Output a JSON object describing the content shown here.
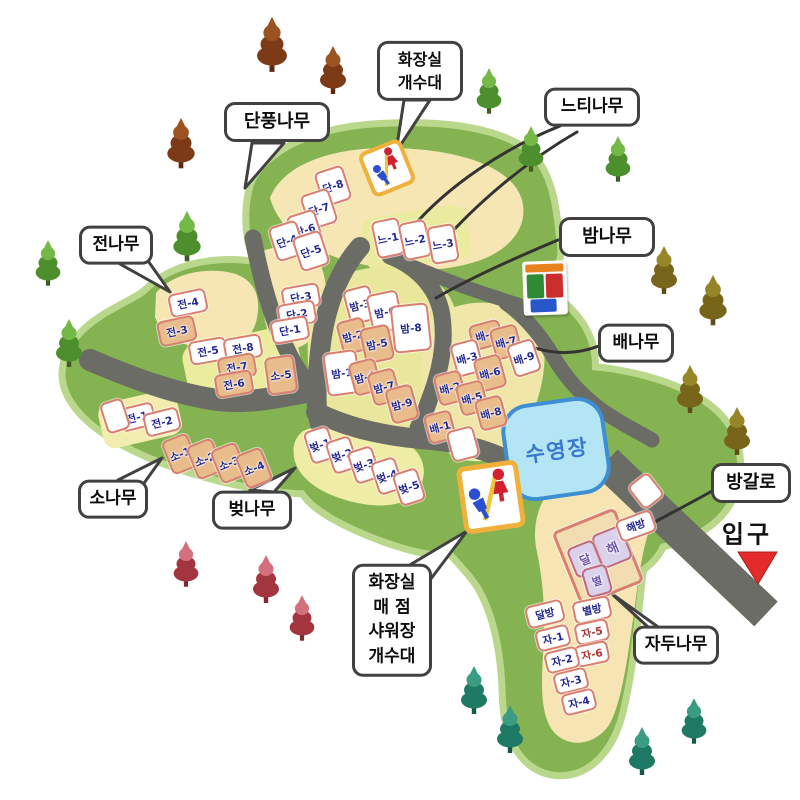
{
  "facilities": {
    "pool_label": "수영장",
    "entrance_label": "입구",
    "restroom_icon": "restroom-sign",
    "recycling_icon": "recycling-bins"
  },
  "colors": {
    "land_green": "#85b351",
    "land_edge": "#bad88c",
    "road_gray": "#6b6c66",
    "cream_area": "#f6e6b4",
    "yellow_area": "#e9e79b",
    "site_border": "#d97f6f",
    "site_tan": "#e9bc8c",
    "label_navy": "#23278f",
    "label_red": "#b03030",
    "label_purple": "#6f58a8",
    "pool_water": "#b3e5f4",
    "pool_border": "#3e8ed2",
    "entrance_arrow": "#e42a2a",
    "restroom_border": "#f0b13c",
    "male_blue": "#2b4fd0",
    "female_red": "#d32030"
  },
  "callouts": [
    {
      "id": "toilet-sink-top",
      "lines": [
        "화장실",
        "개수대"
      ],
      "x": 420,
      "y": 71,
      "w": 86,
      "fs": 16
    },
    {
      "id": "maple",
      "lines": [
        "단풍나무"
      ],
      "x": 277,
      "y": 122,
      "w": 106,
      "fs": 18
    },
    {
      "id": "zelkova",
      "lines": [
        "느티나무"
      ],
      "x": 592,
      "y": 107,
      "w": 96,
      "fs": 17
    },
    {
      "id": "fir",
      "lines": [
        "전나무"
      ],
      "x": 116,
      "y": 245,
      "w": 74,
      "fs": 17
    },
    {
      "id": "chestnut",
      "lines": [
        "밤나무"
      ],
      "x": 607,
      "y": 237,
      "w": 96,
      "fs": 18
    },
    {
      "id": "pear",
      "lines": [
        "배나무"
      ],
      "x": 636,
      "y": 343,
      "w": 76,
      "fs": 17
    },
    {
      "id": "pine",
      "lines": [
        "소나무"
      ],
      "x": 113,
      "y": 499,
      "w": 70,
      "fs": 17
    },
    {
      "id": "cherry",
      "lines": [
        "벚나무"
      ],
      "x": 252,
      "y": 510,
      "w": 80,
      "fs": 17
    },
    {
      "id": "bungalow",
      "lines": [
        "방갈로"
      ],
      "x": 751,
      "y": 483,
      "w": 80,
      "fs": 18
    },
    {
      "id": "plum",
      "lines": [
        "자두나무"
      ],
      "x": 676,
      "y": 645,
      "w": 86,
      "fs": 17
    },
    {
      "id": "services-bottom",
      "lines": [
        "화장실",
        "매 점",
        "샤워장",
        "개수대"
      ],
      "x": 392,
      "y": 620,
      "w": 80,
      "fs": 17
    }
  ],
  "sites": [
    {
      "label": "단-8",
      "x": 333,
      "y": 186,
      "w": 26,
      "h": 32,
      "rot": -18,
      "variant": "white"
    },
    {
      "label": "단-7",
      "x": 319,
      "y": 209,
      "w": 26,
      "h": 32,
      "rot": -18,
      "variant": "white"
    },
    {
      "label": "단-6",
      "x": 305,
      "y": 230,
      "w": 26,
      "h": 32,
      "rot": -18,
      "variant": "white"
    },
    {
      "label": "단-4",
      "x": 287,
      "y": 241,
      "w": 26,
      "h": 32,
      "rot": -18,
      "variant": "white"
    },
    {
      "label": "단-5",
      "x": 311,
      "y": 251,
      "w": 26,
      "h": 32,
      "rot": -18,
      "variant": "white"
    },
    {
      "label": "단-3",
      "x": 301,
      "y": 297,
      "w": 34,
      "h": 20,
      "rot": -10,
      "variant": "white"
    },
    {
      "label": "단-2",
      "x": 297,
      "y": 314,
      "w": 34,
      "h": 20,
      "rot": -10,
      "variant": "white"
    },
    {
      "label": "단-1",
      "x": 290,
      "y": 330,
      "w": 34,
      "h": 20,
      "rot": -10,
      "variant": "white"
    },
    {
      "label": "느-1",
      "x": 388,
      "y": 238,
      "w": 24,
      "h": 34,
      "rot": -12,
      "variant": "white"
    },
    {
      "label": "느-2",
      "x": 415,
      "y": 240,
      "w": 24,
      "h": 34,
      "rot": -12,
      "variant": "white"
    },
    {
      "label": "느-3",
      "x": 443,
      "y": 244,
      "w": 24,
      "h": 34,
      "rot": -10,
      "variant": "white"
    },
    {
      "label": "전-4",
      "x": 188,
      "y": 303,
      "w": 34,
      "h": 20,
      "rot": -12,
      "variant": "white"
    },
    {
      "label": "전-3",
      "x": 177,
      "y": 331,
      "w": 34,
      "h": 22,
      "rot": -12,
      "variant": "tan"
    },
    {
      "label": "전-5",
      "x": 208,
      "y": 351,
      "w": 34,
      "h": 20,
      "rot": -10,
      "variant": "white"
    },
    {
      "label": "전-8",
      "x": 243,
      "y": 348,
      "w": 34,
      "h": 20,
      "rot": -10,
      "variant": "white"
    },
    {
      "label": "전-7",
      "x": 237,
      "y": 367,
      "w": 34,
      "h": 20,
      "rot": -10,
      "variant": "tan"
    },
    {
      "label": "전-6",
      "x": 234,
      "y": 384,
      "w": 34,
      "h": 20,
      "rot": -10,
      "variant": "tan"
    },
    {
      "label": "소-5",
      "x": 281,
      "y": 375,
      "w": 26,
      "h": 34,
      "rot": -8,
      "variant": "tan"
    },
    {
      "label": "전-1",
      "x": 137,
      "y": 417,
      "w": 32,
      "h": 20,
      "rot": -14,
      "variant": "white"
    },
    {
      "label": "전-2",
      "x": 162,
      "y": 422,
      "w": 32,
      "h": 20,
      "rot": -14,
      "variant": "white"
    },
    {
      "label": "",
      "x": 115,
      "y": 416,
      "w": 20,
      "h": 28,
      "rot": -18,
      "variant": "white"
    },
    {
      "label": "소-1",
      "x": 180,
      "y": 454,
      "w": 24,
      "h": 32,
      "rot": -22,
      "variant": "tan"
    },
    {
      "label": "소-2",
      "x": 205,
      "y": 459,
      "w": 24,
      "h": 32,
      "rot": -22,
      "variant": "tan"
    },
    {
      "label": "소-3",
      "x": 229,
      "y": 463,
      "w": 24,
      "h": 32,
      "rot": -22,
      "variant": "tan"
    },
    {
      "label": "소-4",
      "x": 254,
      "y": 468,
      "w": 24,
      "h": 32,
      "rot": -22,
      "variant": "tan"
    },
    {
      "label": "밤-3",
      "x": 360,
      "y": 305,
      "w": 24,
      "h": 32,
      "rot": -15,
      "variant": "white"
    },
    {
      "label": "밤-6",
      "x": 385,
      "y": 312,
      "w": 28,
      "h": 36,
      "rot": -12,
      "variant": "white"
    },
    {
      "label": "밤-8",
      "x": 411,
      "y": 328,
      "w": 34,
      "h": 44,
      "rot": -6,
      "variant": "white"
    },
    {
      "label": "밤-2",
      "x": 353,
      "y": 336,
      "w": 24,
      "h": 30,
      "rot": -15,
      "variant": "tan"
    },
    {
      "label": "밤-5",
      "x": 377,
      "y": 344,
      "w": 26,
      "h": 32,
      "rot": -12,
      "variant": "tan"
    },
    {
      "label": "밤-1",
      "x": 342,
      "y": 373,
      "w": 30,
      "h": 40,
      "rot": -8,
      "variant": "white"
    },
    {
      "label": "밤-4",
      "x": 365,
      "y": 377,
      "w": 24,
      "h": 30,
      "rot": -15,
      "variant": "tan"
    },
    {
      "label": "밤-7",
      "x": 384,
      "y": 387,
      "w": 24,
      "h": 30,
      "rot": -15,
      "variant": "tan"
    },
    {
      "label": "밤-9",
      "x": 402,
      "y": 404,
      "w": 24,
      "h": 32,
      "rot": -15,
      "variant": "tan"
    },
    {
      "label": "배-4",
      "x": 486,
      "y": 335,
      "w": 28,
      "h": 22,
      "rot": -15,
      "variant": "tan"
    },
    {
      "label": "배-7",
      "x": 506,
      "y": 342,
      "w": 24,
      "h": 28,
      "rot": -15,
      "variant": "tan"
    },
    {
      "label": "배-9",
      "x": 524,
      "y": 358,
      "w": 24,
      "h": 30,
      "rot": -18,
      "variant": "white"
    },
    {
      "label": "배-3",
      "x": 467,
      "y": 358,
      "w": 24,
      "h": 30,
      "rot": -15,
      "variant": "white"
    },
    {
      "label": "배-6",
      "x": 490,
      "y": 373,
      "w": 24,
      "h": 30,
      "rot": -15,
      "variant": "tan"
    },
    {
      "label": "배-2",
      "x": 450,
      "y": 388,
      "w": 24,
      "h": 28,
      "rot": -15,
      "variant": "tan"
    },
    {
      "label": "배-5",
      "x": 472,
      "y": 398,
      "w": 24,
      "h": 28,
      "rot": -15,
      "variant": "tan"
    },
    {
      "label": "배-8",
      "x": 491,
      "y": 413,
      "w": 24,
      "h": 28,
      "rot": -15,
      "variant": "tan"
    },
    {
      "label": "배-1",
      "x": 440,
      "y": 427,
      "w": 24,
      "h": 26,
      "rot": -15,
      "variant": "tan"
    },
    {
      "label": "",
      "x": 463,
      "y": 444,
      "w": 24,
      "h": 28,
      "rot": -15,
      "variant": "white"
    },
    {
      "label": "벚-1",
      "x": 320,
      "y": 445,
      "w": 22,
      "h": 30,
      "rot": -18,
      "variant": "white"
    },
    {
      "label": "벚-2",
      "x": 342,
      "y": 455,
      "w": 22,
      "h": 30,
      "rot": -18,
      "variant": "white"
    },
    {
      "label": "벚-3",
      "x": 364,
      "y": 465,
      "w": 22,
      "h": 30,
      "rot": -18,
      "variant": "white"
    },
    {
      "label": "벚-4",
      "x": 387,
      "y": 476,
      "w": 22,
      "h": 30,
      "rot": -18,
      "variant": "white"
    },
    {
      "label": "벚-5",
      "x": 409,
      "y": 487,
      "w": 22,
      "h": 30,
      "rot": -18,
      "variant": "white"
    },
    {
      "label": "",
      "x": 598,
      "y": 557,
      "w": 62,
      "h": 74,
      "rot": -22,
      "variant": "outline"
    },
    {
      "label": "해",
      "x": 612,
      "y": 547,
      "w": 28,
      "h": 32,
      "rot": -22,
      "variant": "purple",
      "fs": 13
    },
    {
      "label": "달",
      "x": 585,
      "y": 559,
      "w": 25,
      "h": 28,
      "rot": -22,
      "variant": "purple",
      "fs": 12
    },
    {
      "label": "별",
      "x": 597,
      "y": 581,
      "w": 22,
      "h": 26,
      "rot": -16,
      "variant": "purple",
      "fs": 11
    },
    {
      "label": "해방",
      "x": 636,
      "y": 526,
      "w": 34,
      "h": 19,
      "rot": -20,
      "variant": "white"
    },
    {
      "label": "별방",
      "x": 592,
      "y": 610,
      "w": 34,
      "h": 19,
      "rot": -12,
      "variant": "white"
    },
    {
      "label": "달방",
      "x": 545,
      "y": 614,
      "w": 34,
      "h": 19,
      "rot": -14,
      "variant": "white"
    },
    {
      "label": "자-5",
      "x": 592,
      "y": 632,
      "w": 30,
      "h": 18,
      "rot": -12,
      "variant": "white",
      "text": "#b03030"
    },
    {
      "label": "자-1",
      "x": 553,
      "y": 638,
      "w": 30,
      "h": 18,
      "rot": -14,
      "variant": "white"
    },
    {
      "label": "자-6",
      "x": 592,
      "y": 654,
      "w": 30,
      "h": 18,
      "rot": -12,
      "variant": "white",
      "text": "#b03030"
    },
    {
      "label": "자-2",
      "x": 562,
      "y": 660,
      "w": 30,
      "h": 18,
      "rot": -14,
      "variant": "white"
    },
    {
      "label": "자-3",
      "x": 571,
      "y": 681,
      "w": 30,
      "h": 18,
      "rot": -14,
      "variant": "white"
    },
    {
      "label": "자-4",
      "x": 579,
      "y": 702,
      "w": 30,
      "h": 18,
      "rot": -14,
      "variant": "white"
    },
    {
      "label": "",
      "x": 646,
      "y": 491,
      "w": 22,
      "h": 26,
      "rot": -38,
      "variant": "white"
    }
  ],
  "tree_colors": {
    "maple": {
      "c1": "#7c3a16",
      "c2": "#9c5322",
      "c3": "#5e2a0e"
    },
    "green": {
      "c1": "#4d8f2c",
      "c2": "#74b847",
      "c3": "#3e5c22"
    },
    "olive": {
      "c1": "#77661a",
      "c2": "#97852a",
      "c3": "#5c4e12"
    },
    "red": {
      "c1": "#a3353e",
      "c2": "#d4707e",
      "c3": "#7e2830"
    },
    "teal": {
      "c1": "#1e7a64",
      "c2": "#3a9c82",
      "c3": "#145848"
    }
  },
  "trees": [
    {
      "type": "maple",
      "x": 272,
      "y": 42,
      "s": 1.15
    },
    {
      "type": "maple",
      "x": 333,
      "y": 68,
      "s": 1.0
    },
    {
      "type": "maple",
      "x": 181,
      "y": 141,
      "s": 1.05
    },
    {
      "type": "green",
      "x": 489,
      "y": 89,
      "s": 0.95
    },
    {
      "type": "green",
      "x": 531,
      "y": 147,
      "s": 0.95
    },
    {
      "type": "green",
      "x": 618,
      "y": 157,
      "s": 0.95
    },
    {
      "type": "green",
      "x": 187,
      "y": 234,
      "s": 1.05
    },
    {
      "type": "green",
      "x": 48,
      "y": 261,
      "s": 0.95
    },
    {
      "type": "green",
      "x": 69,
      "y": 341,
      "s": 1.0
    },
    {
      "type": "olive",
      "x": 664,
      "y": 268,
      "s": 1.0
    },
    {
      "type": "olive",
      "x": 713,
      "y": 298,
      "s": 1.05
    },
    {
      "type": "olive",
      "x": 690,
      "y": 387,
      "s": 1.0
    },
    {
      "type": "olive",
      "x": 737,
      "y": 429,
      "s": 1.0
    },
    {
      "type": "red",
      "x": 186,
      "y": 562,
      "s": 0.95
    },
    {
      "type": "red",
      "x": 266,
      "y": 577,
      "s": 1.0
    },
    {
      "type": "red",
      "x": 302,
      "y": 616,
      "s": 0.95
    },
    {
      "type": "teal",
      "x": 474,
      "y": 688,
      "s": 1.0
    },
    {
      "type": "teal",
      "x": 510,
      "y": 727,
      "s": 1.0
    },
    {
      "type": "teal",
      "x": 642,
      "y": 749,
      "s": 1.0
    },
    {
      "type": "teal",
      "x": 694,
      "y": 719,
      "s": 0.95
    }
  ]
}
